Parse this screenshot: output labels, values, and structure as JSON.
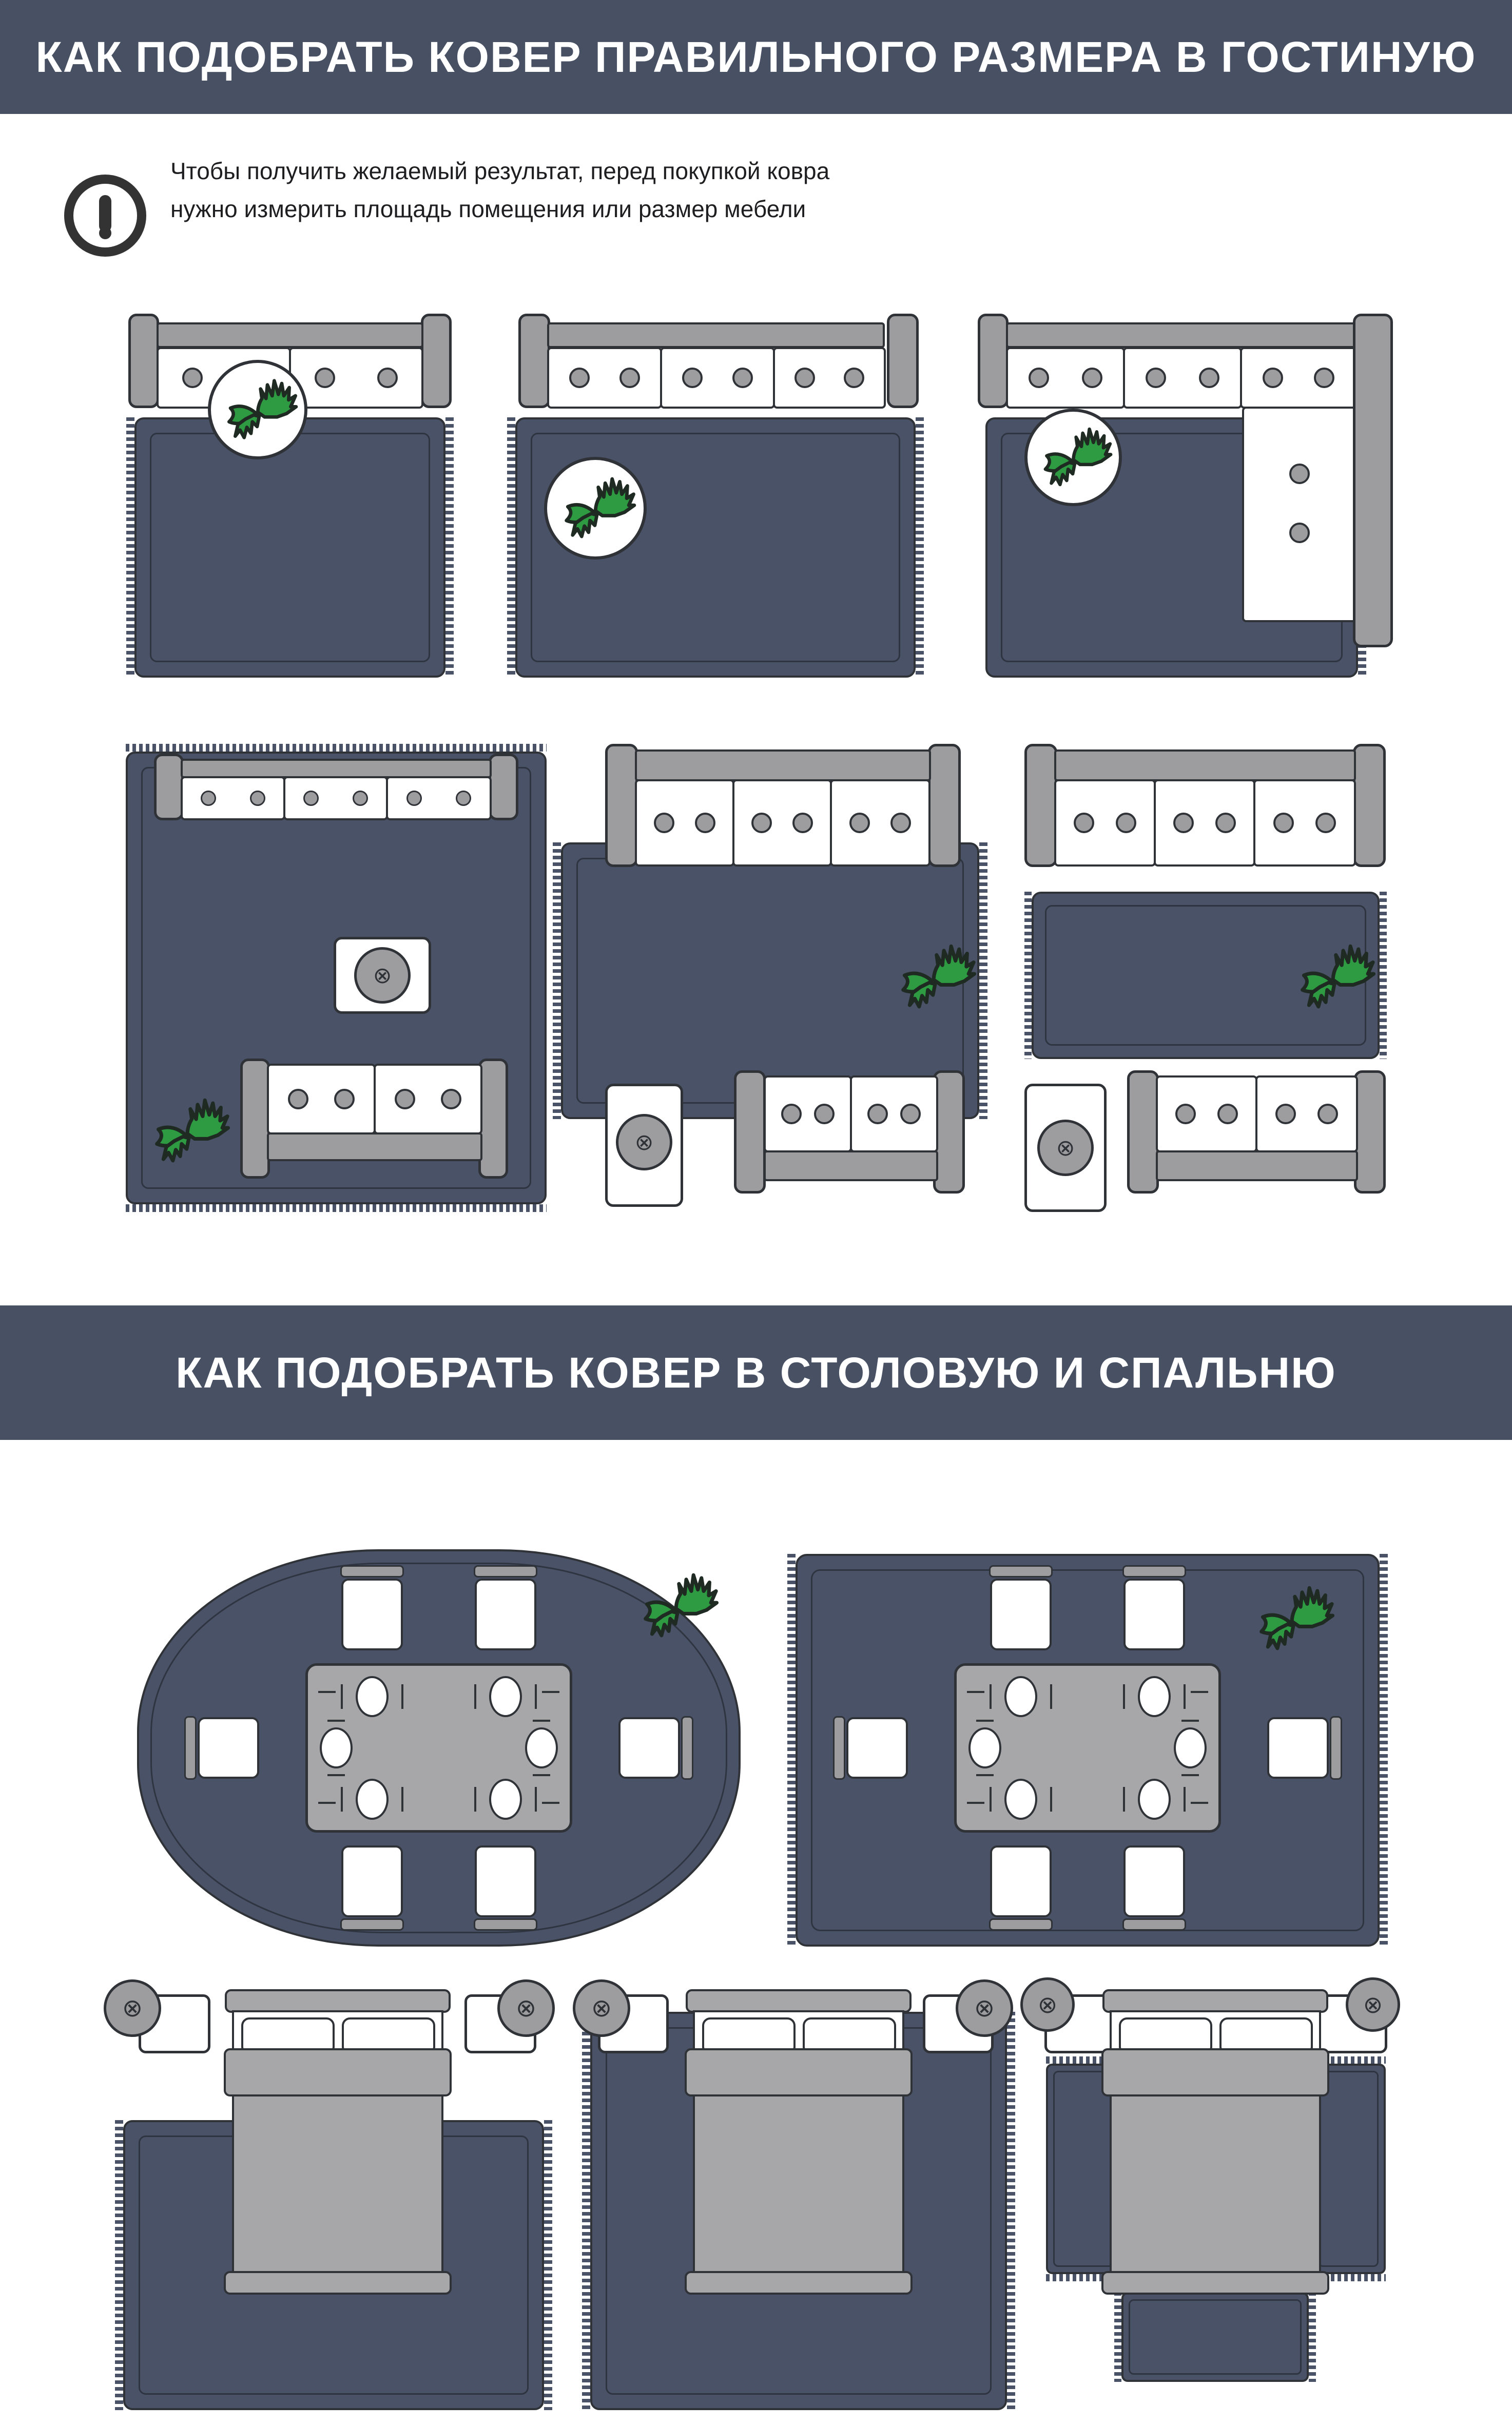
{
  "header_living": {
    "title": "КАК ПОДОБРАТЬ КОВЕР ПРАВИЛЬНОГО РАЗМЕРА В ГОСТИНУЮ"
  },
  "note": {
    "line1": "Чтобы получить желаемый результат, перед покупкой ковра",
    "line2": "нужно измерить площадь помещения или размер мебели"
  },
  "header_dining_bedroom": {
    "title": "КАК ПОДОБРАТЬ КОВЕР В СТОЛОВУЮ И СПАЛЬНЮ"
  },
  "icons": {
    "alert": "!",
    "lamp_cross": "⊗",
    "table_cross": "⊗"
  },
  "colors": {
    "header_bg": "#485064",
    "rug": "#4a5268",
    "rug_line": "#2e3440",
    "outline": "#2f3338",
    "furniture_gray": "#9d9da0",
    "blanket_gray": "#a7a7aa",
    "plant_green": "#2e9a41",
    "text": "#1e1e20",
    "white": "#ffffff"
  }
}
